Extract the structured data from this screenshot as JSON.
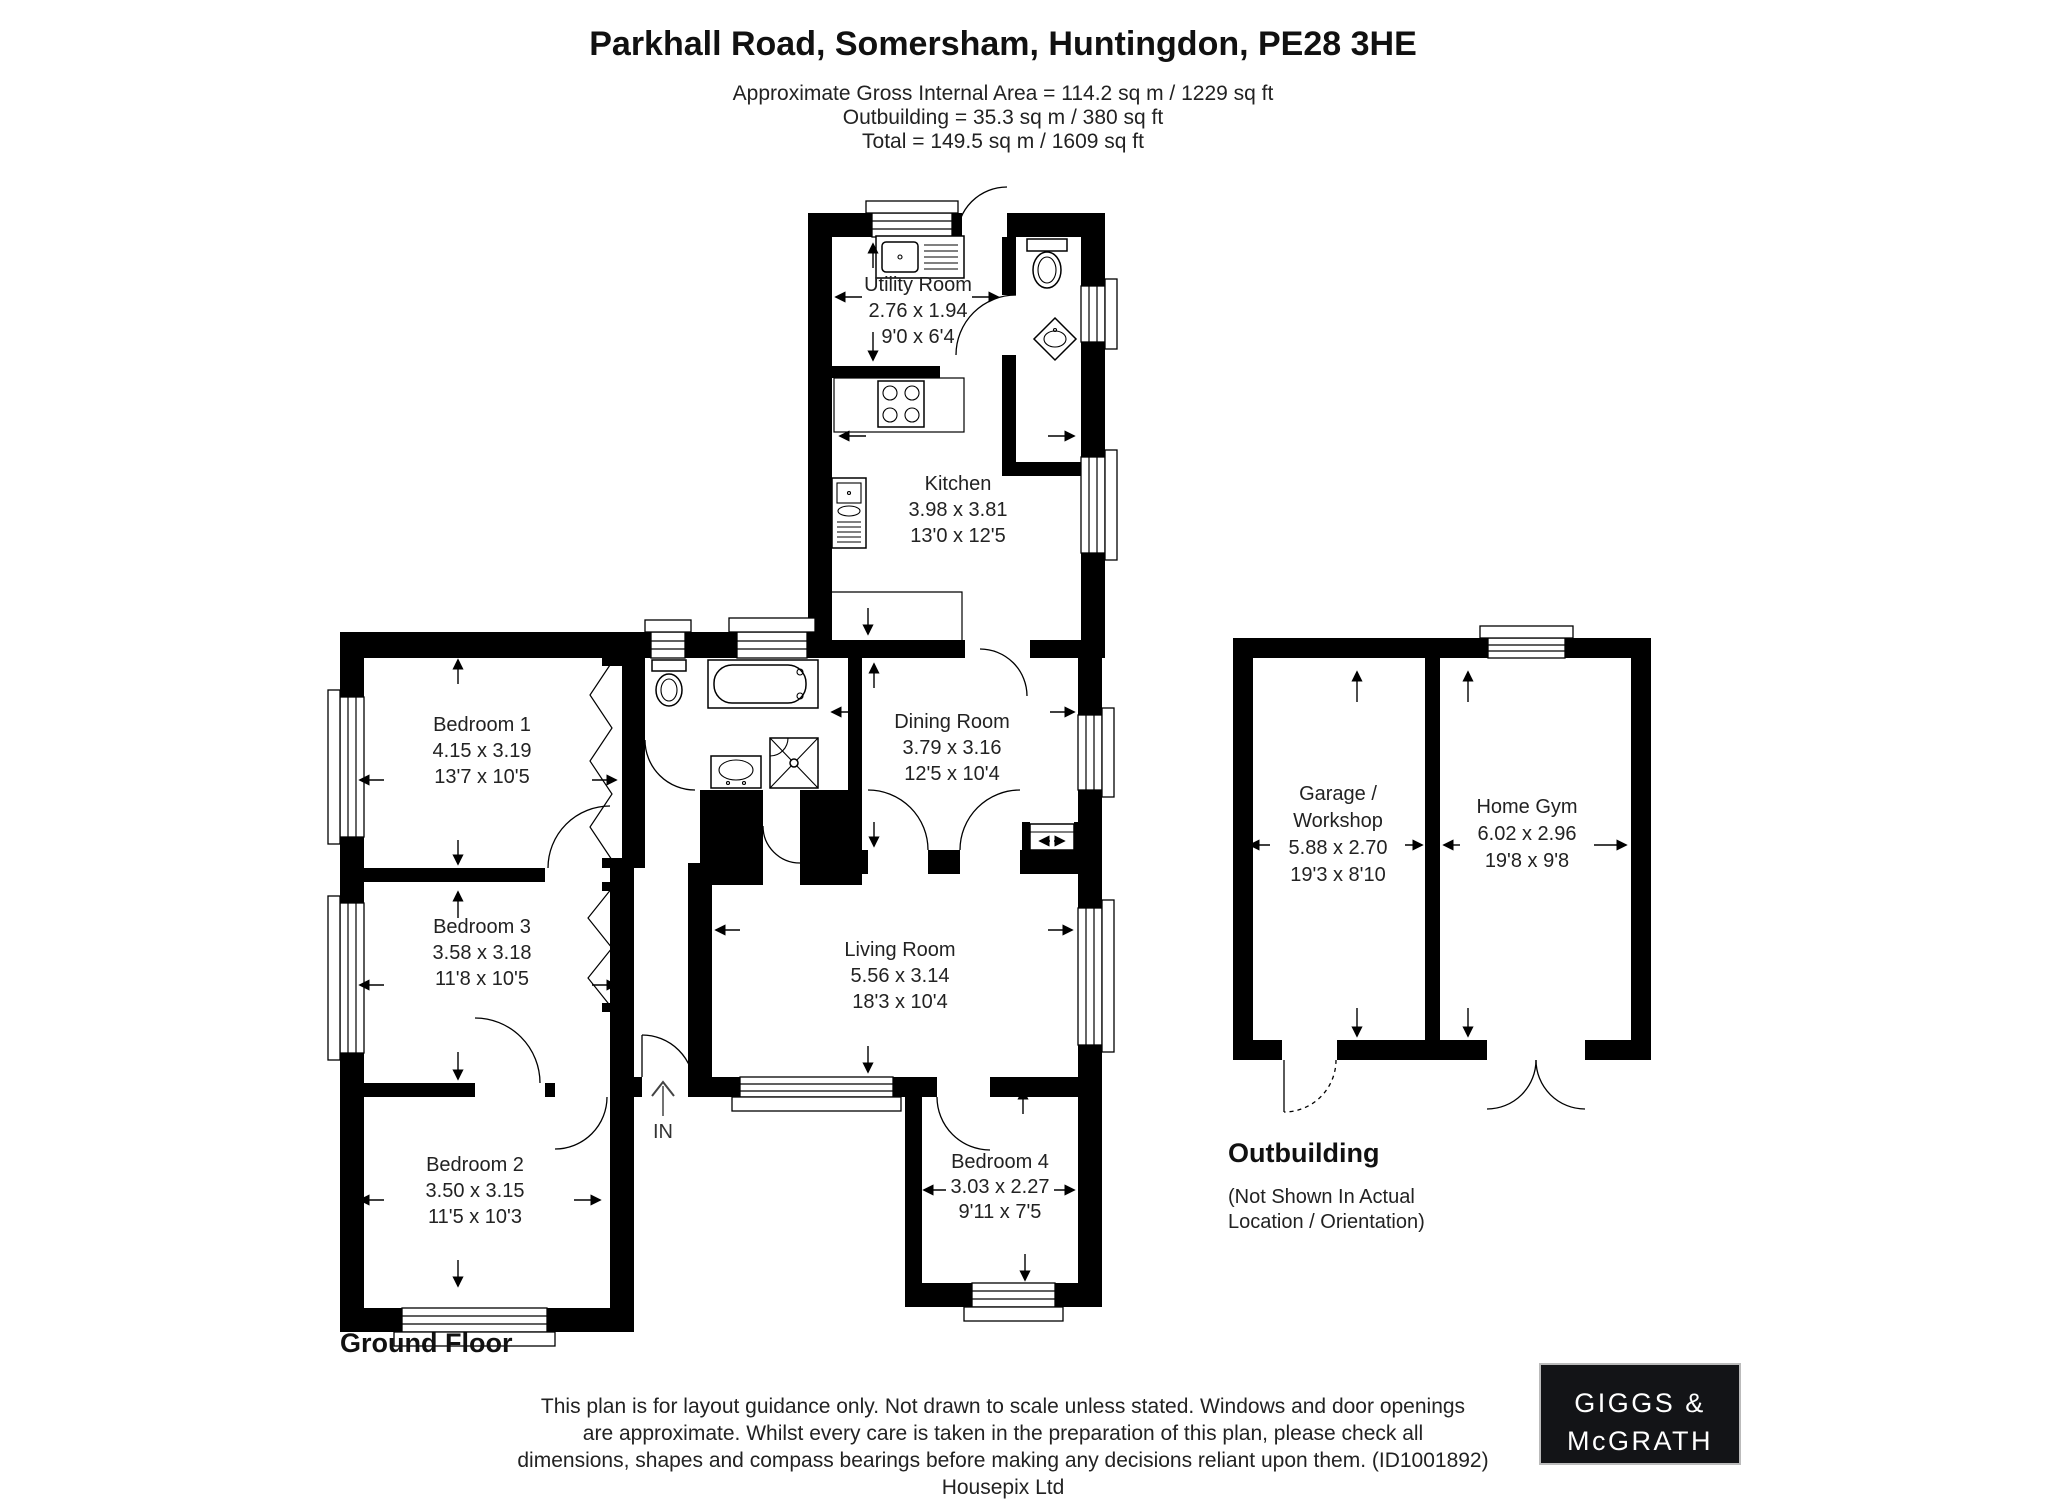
{
  "header": {
    "title": "Parkhall Road, Somersham, Huntingdon, PE28 3HE",
    "area_line1": "Approximate Gross Internal Area = 114.2 sq m / 1229 sq ft",
    "area_line2": "Outbuilding = 35.3 sq m / 380 sq ft",
    "area_line3": "Total = 149.5 sq m / 1609 sq ft"
  },
  "rooms": {
    "utility": {
      "name": "Utility Room",
      "metric": "2.76 x 1.94",
      "imperial": "9'0 x 6'4"
    },
    "kitchen": {
      "name": "Kitchen",
      "metric": "3.98 x 3.81",
      "imperial": "13'0 x 12'5"
    },
    "dining": {
      "name": "Dining Room",
      "metric": "3.79 x 3.16",
      "imperial": "12'5 x 10'4"
    },
    "bedroom1": {
      "name": "Bedroom 1",
      "metric": "4.15 x 3.19",
      "imperial": "13'7 x 10'5"
    },
    "bedroom3": {
      "name": "Bedroom 3",
      "metric": "3.58 x 3.18",
      "imperial": "11'8 x 10'5"
    },
    "bedroom2": {
      "name": "Bedroom 2",
      "metric": "3.50 x 3.15",
      "imperial": "11'5 x 10'3"
    },
    "living": {
      "name": "Living Room",
      "metric": "5.56 x 3.14",
      "imperial": "18'3 x 10'4"
    },
    "bedroom4": {
      "name": "Bedroom 4",
      "metric": "3.03 x 2.27",
      "imperial": "9'11 x 7'5"
    },
    "garage": {
      "name": "Garage /",
      "name2": "Workshop",
      "metric": "5.88 x 2.70",
      "imperial": "19'3 x 8'10"
    },
    "gym": {
      "name": "Home Gym",
      "metric": "6.02 x 2.96",
      "imperial": "19'8 x 9'8"
    }
  },
  "plan": {
    "floor_label": "Ground Floor",
    "entrance_label": "IN",
    "outbuilding_title": "Outbuilding",
    "outbuilding_note1": "(Not Shown In Actual",
    "outbuilding_note2": "Location / Orientation)"
  },
  "footer": {
    "disclaimer_line1": "This plan is for layout guidance only. Not drawn to scale unless stated. Windows and door openings",
    "disclaimer_line2": "are approximate. Whilst every care is taken in the preparation of this plan, please check all",
    "disclaimer_line3": "dimensions, shapes and compass bearings before making any decisions reliant upon them. (ID1001892)",
    "disclaimer_line4": "Housepix Ltd"
  },
  "logo": {
    "line1": "GIGGS &",
    "line2": "McGRATH"
  },
  "colors": {
    "wall": "#000000",
    "background": "#ffffff",
    "logo_bg": "#131417",
    "logo_text": "#ffffff"
  }
}
